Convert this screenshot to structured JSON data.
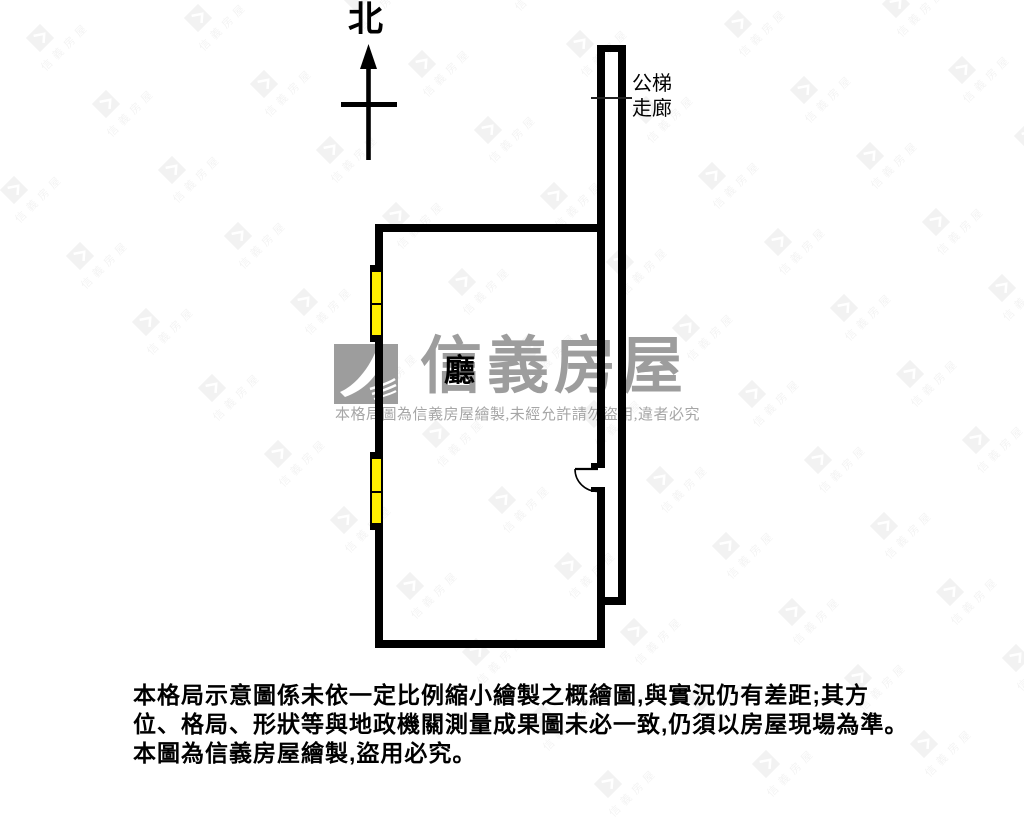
{
  "page": {
    "width": 1024,
    "height": 768,
    "background": "#ffffff"
  },
  "compass": {
    "label": "北"
  },
  "plan": {
    "room_label": "廳",
    "corridor_label_line1": "公梯",
    "corridor_label_line2": "走廊",
    "wall_color": "#000000",
    "window_color": "#ffef00"
  },
  "watermark": {
    "brand": "信義房屋",
    "notice": "本格局圖為信義房屋繪製,未經允許請勿盜用,違者必究",
    "color": "#9d9d9d",
    "logo_icon": "sinyi-swoosh-icon"
  },
  "background_pattern": {
    "brand": "信義房屋"
  },
  "disclaimer": {
    "line1": "本格局示意圖係未依一定比例縮小繪製之概繪圖,與實況仍有差距;其方",
    "line2": "位、格局、形狀等與地政機關測量成果圖未必一致,仍須以房屋現場為準。",
    "line3": "本圖為信義房屋繪製,盜用必究。"
  }
}
